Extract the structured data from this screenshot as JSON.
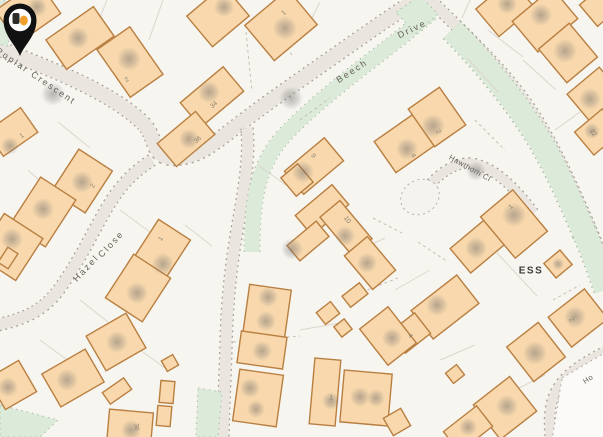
{
  "map": {
    "description": "residential street map with property location pin",
    "colors": {
      "background": "#f7f5f0",
      "road": "#eae6df",
      "road_edge": "#a9a29a",
      "green_verge": "#dcead9",
      "building_fill": "#f8d8ac",
      "building_outline": "#b97f41",
      "street_label": "#67625a",
      "house_number": "#8a8272",
      "ess_label": "#3c3c3c",
      "pin": "#111111",
      "pin_thumb_orange": "#f0a02a"
    },
    "streets": [
      {
        "name": "street-label-poplar-crescent",
        "label": "Poplar Crescent",
        "x": 36,
        "y": 76,
        "rotation": 34,
        "class": "street-lbl"
      },
      {
        "name": "street-label-beech",
        "label": "Beech",
        "x": 352,
        "y": 71,
        "rotation": -33,
        "class": "street-lbl"
      },
      {
        "name": "street-label-drive",
        "label": "Drive",
        "x": 412,
        "y": 29,
        "rotation": -26,
        "class": "street-lbl"
      },
      {
        "name": "street-label-hazel",
        "label": "Hazel",
        "x": 86,
        "y": 268,
        "rotation": -47,
        "class": "street-lbl"
      },
      {
        "name": "street-label-close",
        "label": "Close",
        "x": 111,
        "y": 244,
        "rotation": -47,
        "class": "street-lbl"
      },
      {
        "name": "street-label-hawthorn-cl",
        "label": "Hawthorn Cl",
        "x": 470,
        "y": 168,
        "rotation": 29,
        "class": "street-lbl street-sm"
      },
      {
        "name": "street-label-ho",
        "label": "Ho",
        "x": 588,
        "y": 379,
        "rotation": -35,
        "class": "street-lbl street-sm"
      }
    ],
    "area_labels": [
      {
        "name": "substation-label",
        "label": "ESS",
        "x": 531,
        "y": 271,
        "rotation": 0,
        "class": "ess-lbl"
      }
    ],
    "house_numbers": [
      {
        "label": "2",
        "x": 127,
        "y": 80,
        "rotation": -35
      },
      {
        "label": "1",
        "x": 22,
        "y": 136,
        "rotation": -35
      },
      {
        "label": "1",
        "x": 284,
        "y": 13,
        "rotation": -40
      },
      {
        "label": "34",
        "x": 214,
        "y": 105,
        "rotation": -42
      },
      {
        "label": "36",
        "x": 198,
        "y": 140,
        "rotation": -42
      },
      {
        "label": "2",
        "x": 93,
        "y": 186,
        "rotation": -55
      },
      {
        "label": "1",
        "x": 161,
        "y": 239,
        "rotation": -55
      },
      {
        "label": "9",
        "x": 313,
        "y": 156,
        "rotation": 55
      },
      {
        "label": "10",
        "x": 347,
        "y": 220,
        "rotation": 55
      },
      {
        "label": "4",
        "x": 413,
        "y": 156,
        "rotation": 60
      },
      {
        "label": "2",
        "x": 438,
        "y": 132,
        "rotation": 60
      },
      {
        "label": "22",
        "x": 593,
        "y": 133,
        "rotation": 55
      },
      {
        "label": "1",
        "x": 511,
        "y": 207,
        "rotation": -40
      },
      {
        "label": "4",
        "x": 410,
        "y": 336,
        "rotation": 55
      },
      {
        "label": "2",
        "x": 571,
        "y": 320,
        "rotation": 55
      },
      {
        "label": "1",
        "x": 331,
        "y": 398,
        "rotation": 10
      },
      {
        "label": "36",
        "x": 136,
        "y": 427,
        "rotation": 85
      }
    ],
    "pin": {
      "x": 318,
      "y": 242,
      "meaning": "selected property location"
    }
  }
}
